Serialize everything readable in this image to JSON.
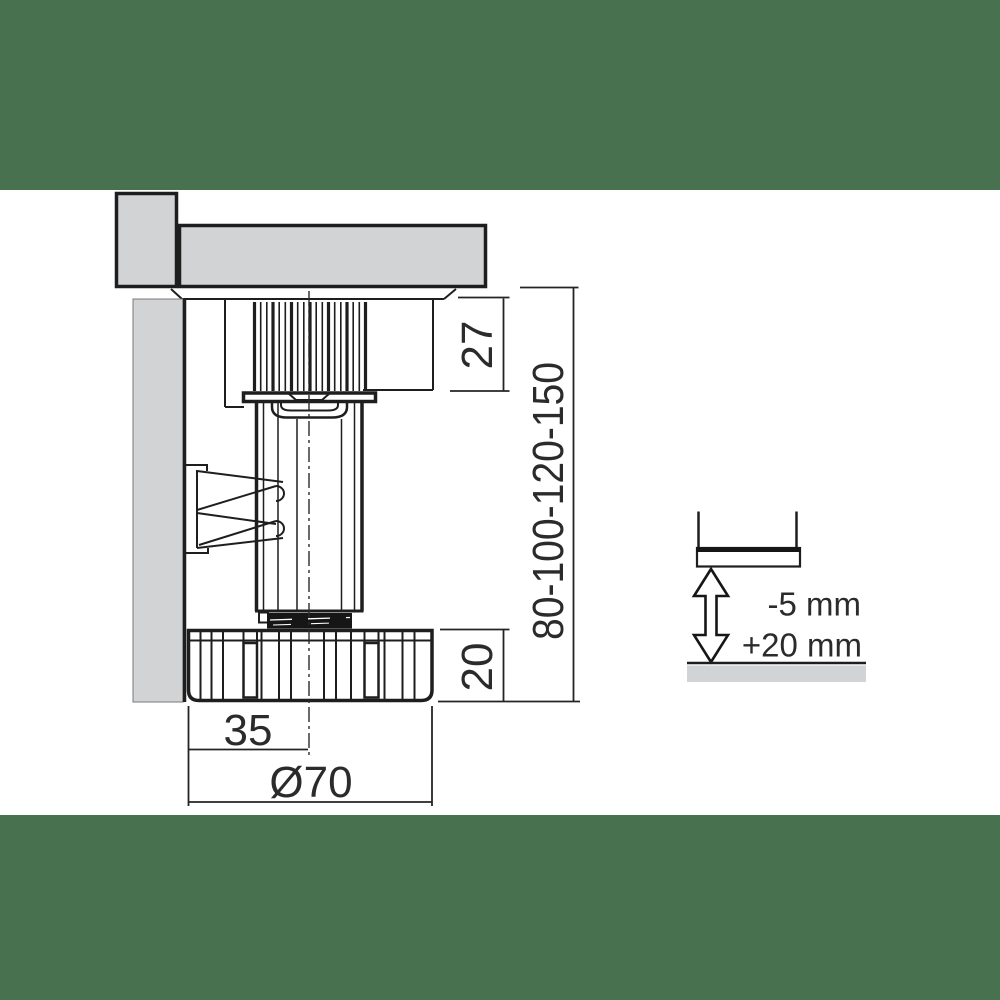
{
  "drawing": {
    "title": "adjustable-plinth-foot-technical-drawing",
    "labels": {
      "thread_height": "27",
      "leg_heights": "80-100-120-150",
      "foot_height": "20",
      "center_offset": "35",
      "foot_diameter": "Ø70"
    },
    "adjustment": {
      "minus": "-5 mm",
      "plus": "+20 mm"
    },
    "colors": {
      "band_green": "#48714f",
      "panel_gray": "#d2d3d5",
      "line_dark": "#1e1e1e",
      "text_dark": "#2b2b2b",
      "background": "#ffffff"
    }
  }
}
